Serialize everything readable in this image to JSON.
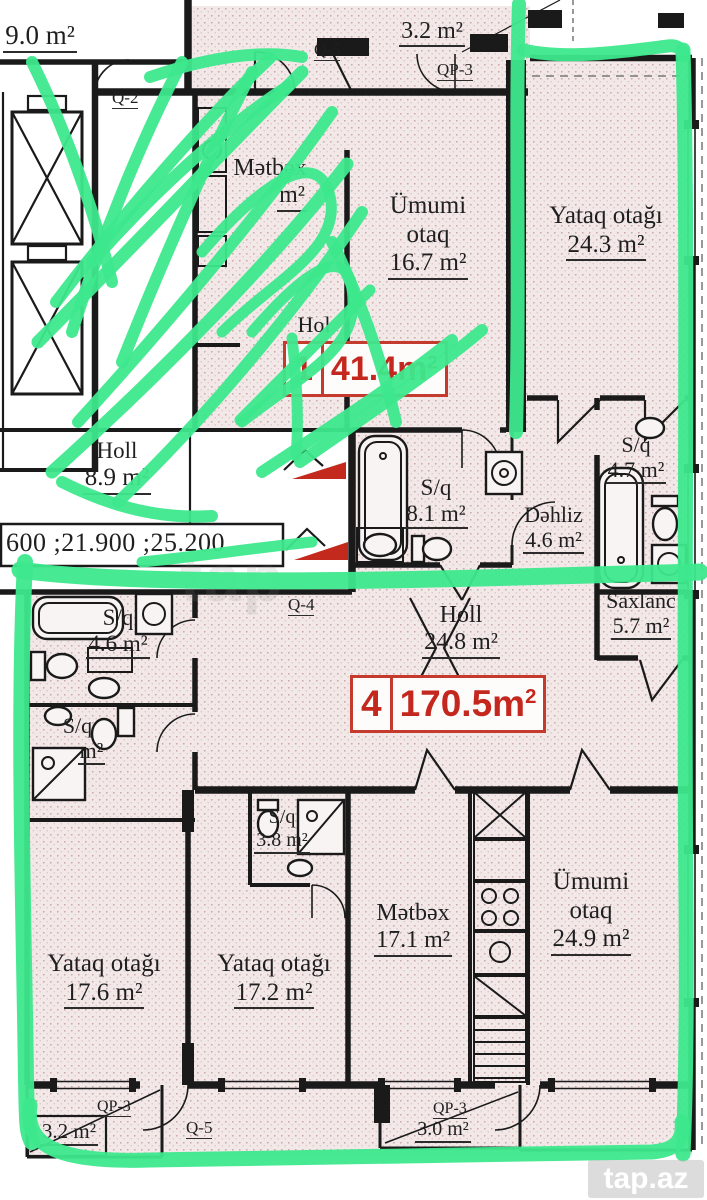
{
  "colors": {
    "annotation_green": "#3de88d",
    "plan_red": "#c4271d",
    "wall": "#1a1a1a",
    "room_fill": "#f2e8e8"
  },
  "watermark": {
    "brand": "tap.az",
    "faint": "tap"
  },
  "dims": "600 ;21.900 ;25.200",
  "tags": [
    {
      "unit": "1",
      "area": "41.4m",
      "sup": "2"
    },
    {
      "unit": "4",
      "area": "170.5m",
      "sup": "2"
    }
  ],
  "labels": {
    "lobby": "9.0 m²",
    "balcony_top": "3.2 m²",
    "balcony_bl": "3.2 m²",
    "balcony_br": "3.0 m²"
  },
  "codes": {
    "q2": "Q-2",
    "q5_top": "Q-5",
    "qp3_top": "QP-3",
    "q4": "Q-4",
    "qp3_bl": "QP-3",
    "q5_bottom": "Q-5",
    "qp3_br": "QP-3"
  },
  "rooms": [
    {
      "lines": [
        "Mətbəx"
      ],
      "area": "m²"
    },
    {
      "lines": [
        "Ümumi",
        "otaq"
      ],
      "area": "16.7 m²"
    },
    {
      "lines": [
        "Yataq otağı"
      ],
      "area": "24.3 m²"
    },
    {
      "lines": [
        "S/q"
      ],
      "area": "8.1 m²"
    },
    {
      "lines": [
        "Dəhliz"
      ],
      "area": "4.6 m²"
    },
    {
      "lines": [
        "S/q"
      ],
      "area": "4.7 m²"
    },
    {
      "lines": [
        "Saxlanc"
      ],
      "area": "5.7 m²"
    },
    {
      "lines": [
        "Holl"
      ],
      "area": "24.8 m²"
    },
    {
      "lines": [
        "S/q"
      ],
      "area": "4.6 m²"
    },
    {
      "lines": [
        "S/q"
      ],
      "area": "m²"
    },
    {
      "lines": [
        "S/q"
      ],
      "area": "3.8 m²"
    },
    {
      "lines": [
        "Mətbəx"
      ],
      "area": "17.1 m²"
    },
    {
      "lines": [
        "Ümumi",
        "otaq"
      ],
      "area": "24.9 m²"
    },
    {
      "lines": [
        "Yataq otağı"
      ],
      "area": "17.6 m²"
    },
    {
      "lines": [
        "Yataq otağı"
      ],
      "area": "17.2 m²"
    },
    {
      "lines": [
        "Holl"
      ],
      "area": "8.9 m²"
    },
    {
      "lines": [
        "Hol"
      ],
      "area": ""
    }
  ]
}
